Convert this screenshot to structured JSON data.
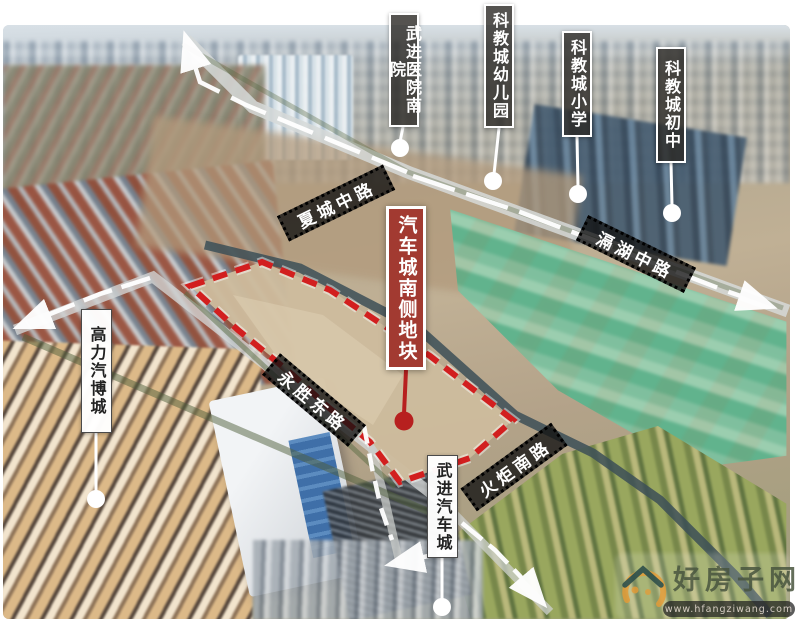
{
  "callouts": {
    "hospital": {
      "label": "武进医院南院"
    },
    "kindergarten": {
      "label": "科教城幼儿园"
    },
    "primary_school": {
      "label": "科教城小学"
    },
    "junior_high": {
      "label": "科教城初中"
    },
    "gaoli_auto_expo": {
      "label": "高力汽博城"
    },
    "wujin_auto_city": {
      "label": "武进汽车城"
    }
  },
  "site": {
    "label": "汽车城南侧地块"
  },
  "road_banners": {
    "xiacheng": {
      "label": "夏城中路"
    },
    "gehu": {
      "label": "滆湖中路"
    },
    "yongsheng": {
      "label": "永胜东路"
    },
    "huoju": {
      "label": "火炬南路"
    }
  },
  "watermark": {
    "brand": "好房子网",
    "url": "www.hfangziwang.com"
  },
  "colors": {
    "accent_red": "#d21f1f",
    "site_label_bg": "#a23a31",
    "anchor_red": "#b7201f",
    "watermark_green": "#49553f",
    "watermark_orange": "#e59b35"
  }
}
